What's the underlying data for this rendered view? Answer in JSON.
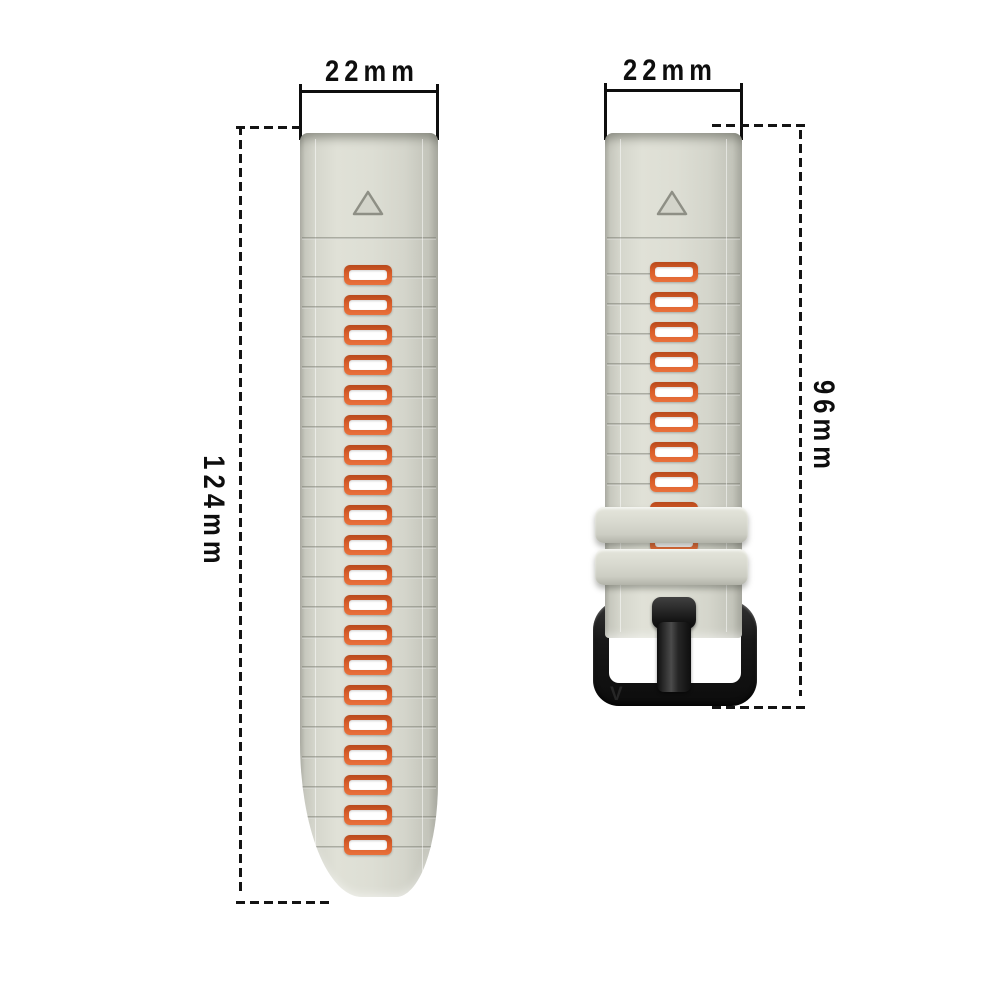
{
  "title": "Two-tone silicone watch strap size diagram",
  "annotations": {
    "left_strap_width": "22mm",
    "right_strap_width": "22mm",
    "left_strap_length": "124mm",
    "right_strap_length": "96mm"
  },
  "colors": {
    "background": "#ffffff",
    "strap_body": "#d6d7cd",
    "strap_edge": "#a9aaa0",
    "accent_orange": "#d95d2a",
    "hole_inner": "#ffffff",
    "buckle_black": "#181818",
    "dimension_ink": "#0e0e0e"
  },
  "left_strap": {
    "hole_count": 20,
    "groove_count": 21,
    "has_alignment_triangle": true
  },
  "right_strap": {
    "hole_count": 10,
    "groove_count": 10,
    "keeper_count": 2,
    "has_buckle": true,
    "buckle_logo": "V",
    "has_alignment_triangle": true
  }
}
